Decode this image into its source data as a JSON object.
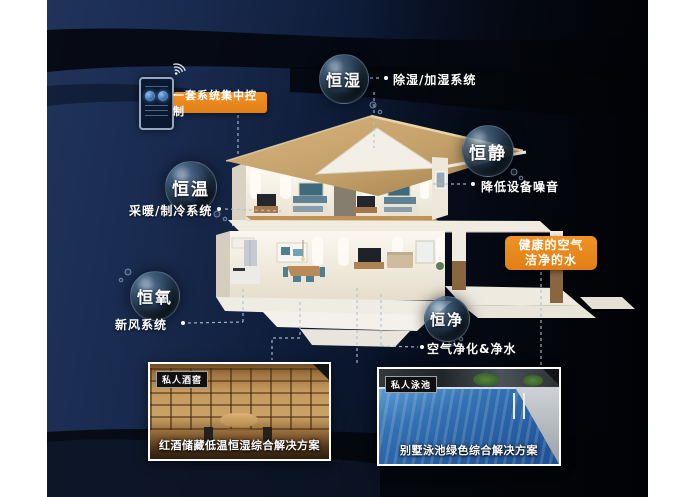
{
  "colors": {
    "accent": "#E8891E",
    "background_deep": "#0A1426",
    "background_light": "#1E3156"
  },
  "control_banner": {
    "label": "一套系统集中控制"
  },
  "features": [
    {
      "id": "humidity",
      "bubble": "恒湿",
      "label": "除湿/加湿系统"
    },
    {
      "id": "quiet",
      "bubble": "恒静",
      "label": "降低设备噪音"
    },
    {
      "id": "temperature",
      "bubble": "恒温",
      "label": "采暖/制冷系统"
    },
    {
      "id": "oxygen",
      "bubble": "恒氧",
      "label": "新风系统"
    },
    {
      "id": "purity",
      "bubble": "恒净",
      "label": "空气净化&净水"
    }
  ],
  "highlight_card": {
    "line1": "健康的空气",
    "line2": "洁净的水"
  },
  "solution_cards": [
    {
      "id": "wine-cellar",
      "tag": "私人酒窖",
      "caption": "红酒储藏低温恒湿综合解决方案"
    },
    {
      "id": "pool",
      "tag": "私人泳池",
      "caption": "别墅泳池绿色综合解决方案"
    }
  ]
}
